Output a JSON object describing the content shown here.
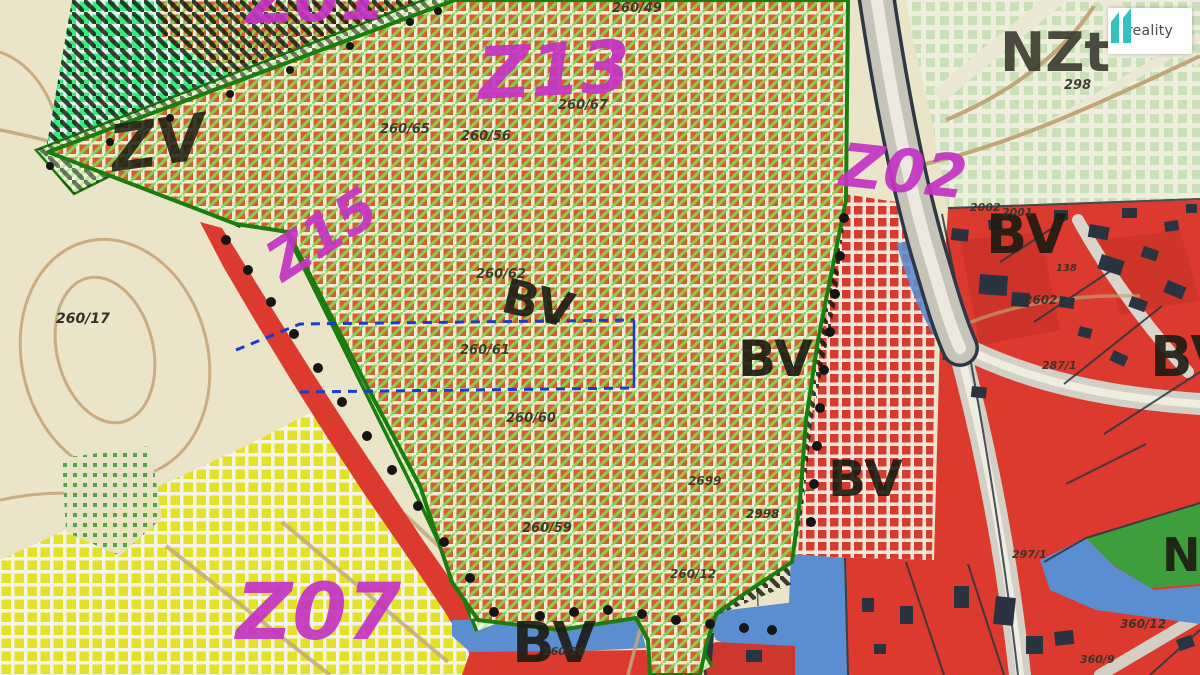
{
  "logo": {
    "brand": "reality",
    "mark": "11"
  },
  "map": {
    "zones": {
      "z01": "Z01",
      "z13": "Z13",
      "z02": "Z02",
      "z15": "Z15",
      "z07": "Z07",
      "nzt": "NZt",
      "zv": "ZV",
      "bv": "BV",
      "n_partial": "N"
    },
    "parcels": [
      "260/49",
      "260/67",
      "260/65",
      "260/56",
      "260/62",
      "260/61",
      "260/60",
      "260/59",
      "2699",
      "2998",
      "260/12",
      "260/20",
      "260/17",
      "298",
      "2002",
      "2001",
      "138",
      "2602",
      "287/1",
      "297/1",
      "360/12",
      "360/9"
    ]
  },
  "colors": {
    "zone_label_magenta": "#c433c4",
    "zone_border_green": "#1d7c10",
    "residential_red": "#dc3a2e",
    "water_blue": "#5b8ed0",
    "plan_dashed_blue": "#1a3ecb",
    "logo_teal": "#34c2c0"
  }
}
